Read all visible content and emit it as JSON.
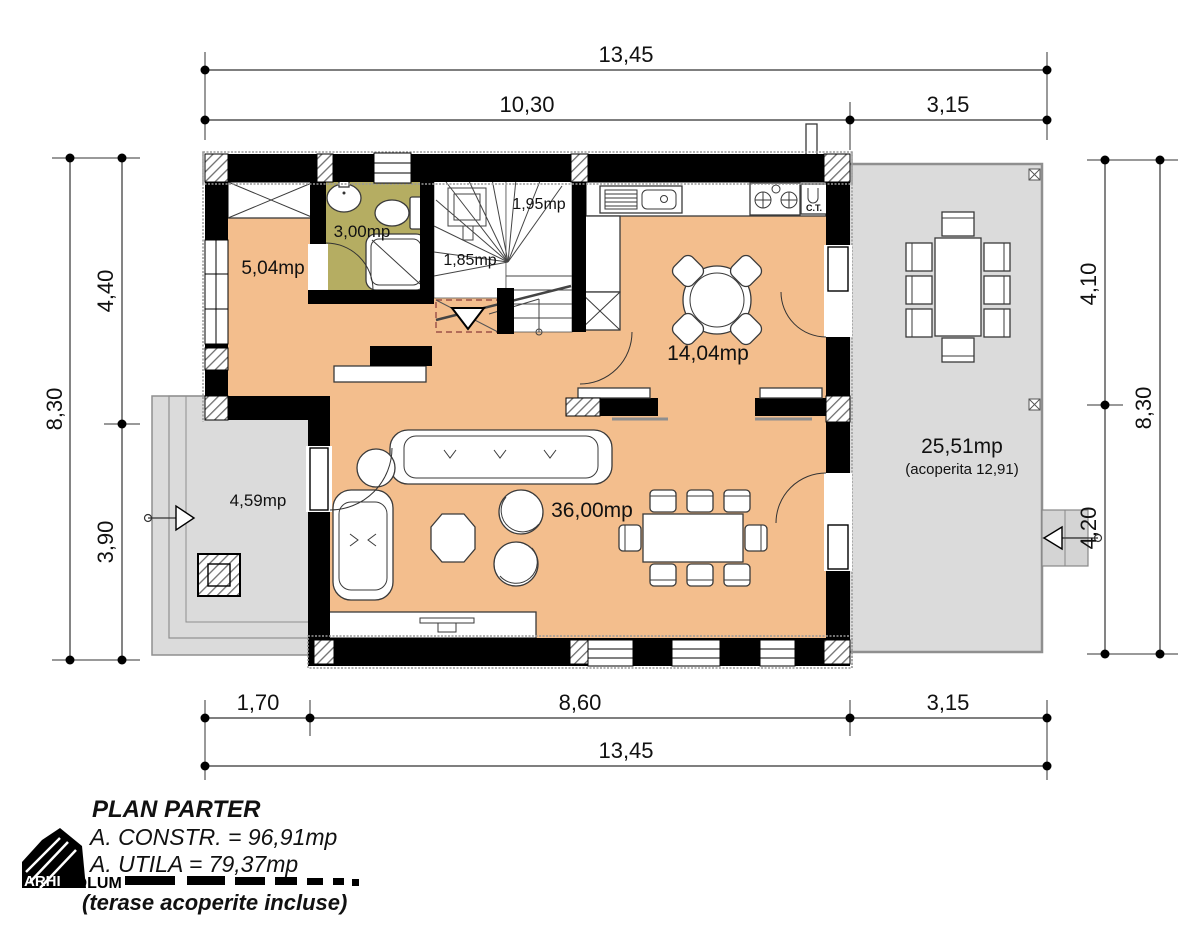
{
  "colors": {
    "floor": "#F3BE8D",
    "bathroom": "#B5AD62",
    "terrace": "#DBDBDB",
    "wall": "#000000"
  },
  "rooms": {
    "hall_area": "5,04mp",
    "bath_area": "3,00mp",
    "stair_lower_area": "1,85mp",
    "stair_upper_area": "1,95mp",
    "kitchen_area": "14,04mp",
    "living_area": "36,00mp",
    "terrace_left_area": "4,59mp",
    "terrace_right_area": "25,51mp",
    "terrace_right_note": "(acoperita 12,91)",
    "boiler_label": "C.T."
  },
  "dimensions": {
    "top_total": "13,45",
    "top_main": "10,30",
    "top_terrace": "3,15",
    "bottom_terrace": "1,70",
    "bottom_main": "8,60",
    "bottom_right": "3,15",
    "bottom_total": "13,45",
    "left_upper": "4,40",
    "left_lower": "3,90",
    "left_total": "8,30",
    "right_upper": "4,10",
    "right_lower": "4,20",
    "right_total": "8,30"
  },
  "legend": {
    "title": "PLAN PARTER",
    "built_area": "A. CONSTR. = 96,91mp",
    "usable_area": "A. UTILA = 79,37mp",
    "note": "(terase acoperite incluse)"
  },
  "logo": {
    "part1": "ARHI",
    "part2": "VOLUM"
  }
}
